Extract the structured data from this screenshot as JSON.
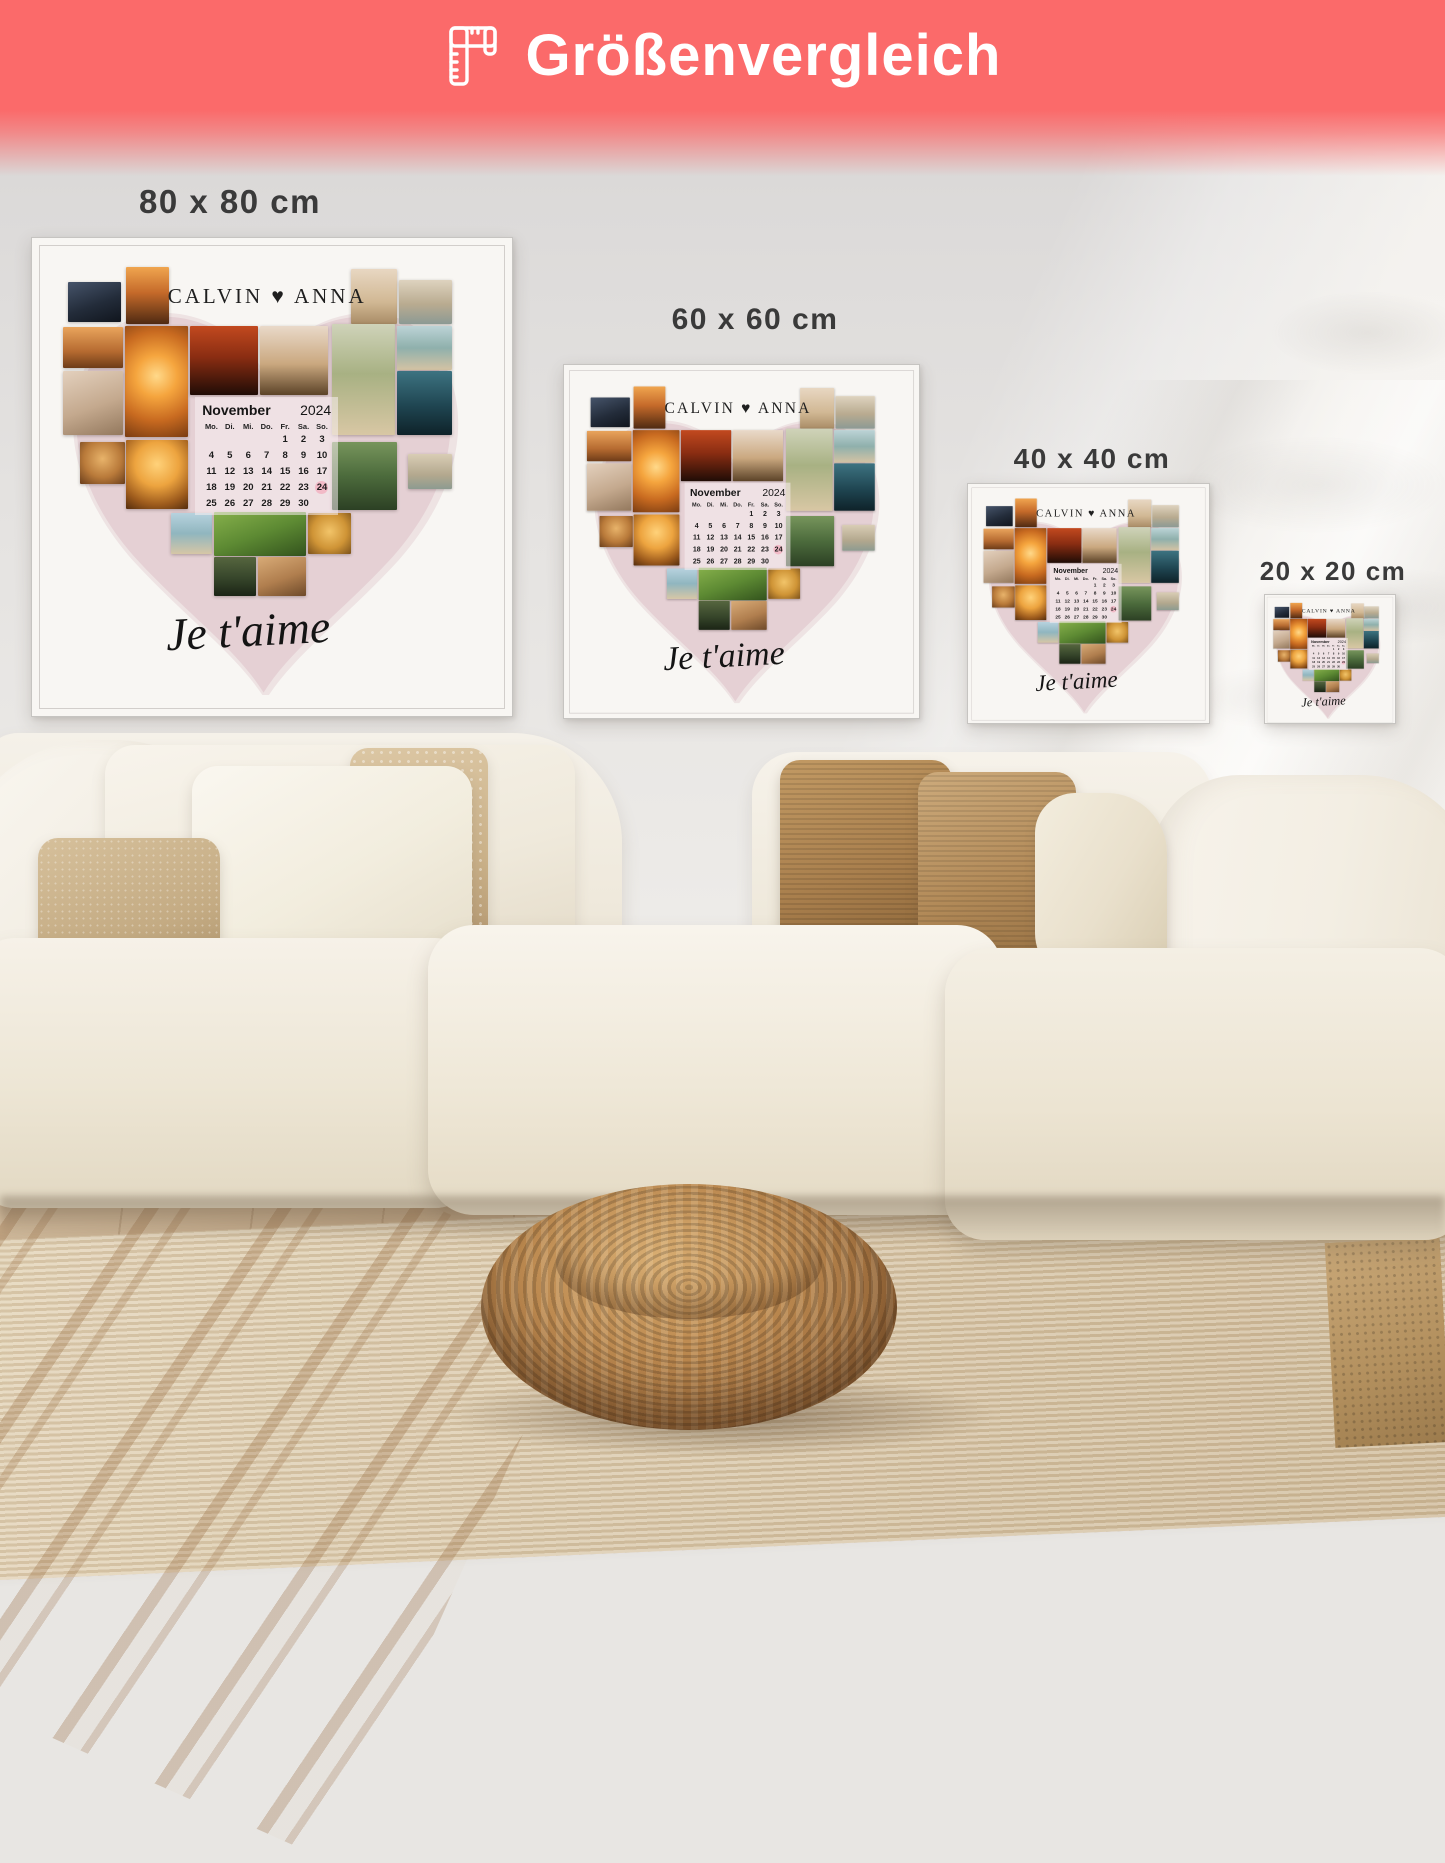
{
  "banner": {
    "title": "Größenvergleich",
    "icon": "ruler-icon",
    "bg_color": "#fb6a6a",
    "text_color": "#ffffff"
  },
  "size_labels": [
    {
      "label": "80 x 80 cm"
    },
    {
      "label": "60 x 60 cm"
    },
    {
      "label": "40 x 40 cm"
    },
    {
      "label": "20 x 20 cm"
    }
  ],
  "poster": {
    "title": "CALVIN ♥ ANNA",
    "caption": "Je t'aime",
    "heart_color": "#e4cfd3",
    "calendar": {
      "month": "November",
      "year": "2024",
      "weekdays": [
        "Mo.",
        "Di.",
        "Mi.",
        "Do.",
        "Fr.",
        "Sa.",
        "So."
      ],
      "weeks": [
        [
          "",
          "",
          "",
          "",
          "1",
          "2",
          "3"
        ],
        [
          "4",
          "5",
          "6",
          "7",
          "8",
          "9",
          "10"
        ],
        [
          "11",
          "12",
          "13",
          "14",
          "15",
          "16",
          "17"
        ],
        [
          "18",
          "19",
          "20",
          "21",
          "22",
          "23",
          "24"
        ],
        [
          "25",
          "26",
          "27",
          "28",
          "29",
          "30",
          ""
        ]
      ],
      "highlight_day": "24",
      "highlight_color": "#f2bac7"
    },
    "photos": [
      {
        "name": "dark-silhouette-couple",
        "gradient": "linear-gradient(160deg,#46546a 0%,#232c3a 55%,#10151d 100%)"
      },
      {
        "name": "sunset-walk",
        "gradient": "linear-gradient(180deg,#f0a54f 0%,#c56a2a 45%,#4f2a12 100%)"
      },
      {
        "name": "beach-woman-white-dress",
        "gradient": "linear-gradient(180deg,#e8d7c2 0%,#d1b894 60%,#a98c66 100%)"
      },
      {
        "name": "beach-couple-walk",
        "gradient": "linear-gradient(180deg,#ded3bf 0%,#b9ab90 55%,#8c9a94 100%)"
      },
      {
        "name": "sunset-couple",
        "gradient": "linear-gradient(180deg,#e9a45c 0%,#b56a30 60%,#6e3c18 100%)"
      },
      {
        "name": "beach-chairs-sunset",
        "gradient": "radial-gradient(circle at 50% 45%,#ffd98a 0%,#f5a53e 30%,#c86a20 65%,#7a3c12 100%)"
      },
      {
        "name": "red-sunset-silhouette",
        "gradient": "linear-gradient(180deg,#c2491f 0%,#8a2d12 45%,#200c06 100%)"
      },
      {
        "name": "field-couple-silhouette",
        "gradient": "linear-gradient(180deg,#e9d9c9 0%,#caa87f 55%,#5c4328 100%)"
      },
      {
        "name": "dunes-wedding-couple",
        "gradient": "linear-gradient(180deg,#cfd3b9 0%,#a8b183 45%,#d8c7a4 100%)"
      },
      {
        "name": "beach-couple-sea",
        "gradient": "linear-gradient(180deg,#bcd3d6 0%,#8fb0ac 50%,#d4c3a4 100%)"
      },
      {
        "name": "hugging-couple",
        "gradient": "linear-gradient(160deg,#e3d0bd 0%,#c4a98e 55%,#93785d 100%)"
      },
      {
        "name": "teal-evening-couple",
        "gradient": "linear-gradient(180deg,#3d7381 0%,#1f4551 55%,#0e2229 100%)"
      },
      {
        "name": "party-cheers",
        "gradient": "radial-gradient(circle at 50% 40%,#e8b36a 0%,#b97a3a 55%,#6b3f1c 100%)"
      },
      {
        "name": "heart-hands-sunset",
        "gradient": "radial-gradient(circle at 50% 35%,#ffd27a 0%,#eda43f 40%,#9c5a1c 75%,#542d0e 100%)"
      },
      {
        "name": "wedding-walk-arch",
        "gradient": "linear-gradient(180deg,#77955c 0%,#4c6b3c 50%,#2c4024 100%)"
      },
      {
        "name": "beach-pair-small",
        "gradient": "linear-gradient(180deg,#d9cdb5 0%,#b3a88e 60%,#8d9b90 100%)"
      },
      {
        "name": "beach-walk-sea",
        "gradient": "linear-gradient(180deg,#b7d2de 0%,#90b6bf 50%,#d6c6a6 100%)"
      },
      {
        "name": "grass-couple",
        "gradient": "linear-gradient(160deg,#86b04b 0%,#5d8a33 50%,#33531d 100%)"
      },
      {
        "name": "pinky-promise-hands",
        "gradient": "radial-gradient(circle at 50% 45%,#f2c469 0%,#cf9436 55%,#7c521b 100%)"
      },
      {
        "name": "forest-kiss",
        "gradient": "linear-gradient(180deg,#56663f 0%,#36452a 55%,#1b2415 100%)"
      },
      {
        "name": "smiling-hug-couple",
        "gradient": "linear-gradient(160deg,#d8ab77 0%,#b07e4e 55%,#6e4a2a 100%)"
      }
    ]
  }
}
